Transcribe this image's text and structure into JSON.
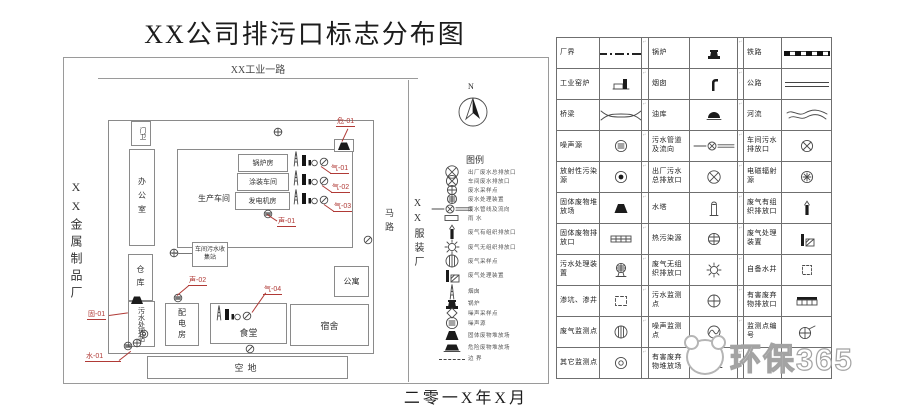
{
  "page": {
    "title": "XX公司排污口标志分布图",
    "date_label": "二零一X年X月"
  },
  "map": {
    "top_road": "XX工业一路",
    "left_neighbor": "XX金属制品厂",
    "right_neighbor": "XX服装厂",
    "road": "马路",
    "north_label": "N",
    "legend_title": "图例",
    "buildings": [
      {
        "id": "gate",
        "label": "门卫",
        "vertical": true
      },
      {
        "id": "office",
        "label": "办公室",
        "vertical": true
      },
      {
        "id": "workshop",
        "label": "生产车间",
        "vertical": false
      },
      {
        "id": "boiler-room",
        "label": "锅炉房",
        "vertical": false
      },
      {
        "id": "paint-shop",
        "label": "涂装车间",
        "vertical": false
      },
      {
        "id": "generator-room",
        "label": "发电机房",
        "vertical": false
      },
      {
        "id": "sewage-collect",
        "label": "车间污水收集站",
        "vertical": false
      },
      {
        "id": "warehouse",
        "label": "仓库",
        "vertical": true
      },
      {
        "id": "sewage-plant",
        "label": "污水处理站",
        "vertical": true
      },
      {
        "id": "power-room",
        "label": "配电房",
        "vertical": true
      },
      {
        "id": "canteen",
        "label": "食堂",
        "vertical": false
      },
      {
        "id": "dorm",
        "label": "宿舍",
        "vertical": false
      },
      {
        "id": "apartment",
        "label": "公寓",
        "vertical": false
      },
      {
        "id": "empty-lot",
        "label": "空地",
        "vertical": false
      }
    ],
    "tags": [
      {
        "id": "hazard-01",
        "label": "危-01"
      },
      {
        "id": "gas-01",
        "label": "气-01"
      },
      {
        "id": "gas-02",
        "label": "气-02"
      },
      {
        "id": "gas-03",
        "label": "气-03"
      },
      {
        "id": "gas-04",
        "label": "气-04"
      },
      {
        "id": "noise-01",
        "label": "声-01"
      },
      {
        "id": "noise-02",
        "label": "声-02"
      },
      {
        "id": "solid-01",
        "label": "固-01"
      },
      {
        "id": "water-01",
        "label": "水-01"
      }
    ],
    "mini_legend": [
      {
        "icon": "outlet-main",
        "label": "出厂废水总排放口"
      },
      {
        "icon": "outlet-workshop",
        "label": "车间废水排放口"
      },
      {
        "icon": "sample-point",
        "label": "废水采样点"
      },
      {
        "icon": "device-circle",
        "label": "废水处理装置"
      },
      {
        "icon": "pipe-flow",
        "label": "废水管线及流向"
      },
      {
        "icon": "rainwater",
        "label": "雨  水"
      },
      {
        "icon": "stack-black",
        "label": "废气有组织排放口"
      },
      {
        "icon": "sun",
        "label": "废气无组织排放口"
      },
      {
        "icon": "monitor-gas",
        "label": "废气采样点"
      },
      {
        "icon": "gas-treat",
        "label": "废气处理装置"
      },
      {
        "icon": "chimney-tower",
        "label": "烟囱"
      },
      {
        "icon": "boiler",
        "label": "锅炉"
      },
      {
        "icon": "noise-sample",
        "label": "噪声采样点"
      },
      {
        "icon": "noise-source",
        "label": "噪声源"
      },
      {
        "icon": "solid-waste",
        "label": "固体废物堆放场"
      },
      {
        "icon": "harmful-site",
        "label": "危险废物堆放场"
      },
      {
        "icon": "border-dash",
        "label": "边  界"
      }
    ]
  },
  "legend_table": {
    "rows": [
      [
        {
          "label": "厂界",
          "icon": "boundary-line"
        },
        {
          "label": "锅炉",
          "icon": "boiler"
        },
        {
          "label": "铁路",
          "icon": "railway"
        }
      ],
      [
        {
          "label": "工业窑炉",
          "icon": "kiln"
        },
        {
          "label": "烟囱",
          "icon": "chimney"
        },
        {
          "label": "公路",
          "icon": "highway"
        }
      ],
      [
        {
          "label": "桥梁",
          "icon": "bridge"
        },
        {
          "label": "油库",
          "icon": "oil-depot"
        },
        {
          "label": "河流",
          "icon": "river"
        }
      ],
      [
        {
          "label": "噪声源",
          "icon": "noise-source"
        },
        {
          "label": "污水管道及流向",
          "icon": "pipe-flow"
        },
        {
          "label": "车间污水排放口",
          "icon": "outlet-workshop"
        }
      ],
      [
        {
          "label": "放射性污染源",
          "icon": "radioactive"
        },
        {
          "label": "出厂污水总排放口",
          "icon": "outlet-main"
        },
        {
          "label": "电磁辐射源",
          "icon": "emag"
        }
      ],
      [
        {
          "label": "固体废物堆放场",
          "icon": "solid-waste"
        },
        {
          "label": "水塔",
          "icon": "water-tower"
        },
        {
          "label": "废气有组织排放口",
          "icon": "stack-black"
        }
      ],
      [
        {
          "label": "固体废物排放口",
          "icon": "solid-outlet"
        },
        {
          "label": "热污染源",
          "icon": "thermal"
        },
        {
          "label": "废气处理装置",
          "icon": "gas-treat"
        }
      ],
      [
        {
          "label": "污水处理装置",
          "icon": "sewage-treat"
        },
        {
          "label": "废气无组织排放口",
          "icon": "sun"
        },
        {
          "label": "自备水井",
          "icon": "well"
        }
      ],
      [
        {
          "label": "渗坑、渗井",
          "icon": "seepage"
        },
        {
          "label": "污水监测点",
          "icon": "monitor-water"
        },
        {
          "label": "有害废弃物排放口",
          "icon": "harmful-outlet"
        }
      ],
      [
        {
          "label": "废气监测点",
          "icon": "monitor-gas"
        },
        {
          "label": "噪声监测点",
          "icon": "monitor-noise"
        },
        {
          "label": "监测点编号",
          "icon": "monitor-num"
        }
      ],
      [
        {
          "label": "其它监测点",
          "icon": "monitor-other"
        },
        {
          "label": "有害废弃物堆放场",
          "icon": "harmful-site"
        },
        {
          "label": "",
          "icon": ""
        }
      ]
    ]
  },
  "watermark": {
    "text": "环保365"
  },
  "colors": {
    "tag_red": "#b03a36",
    "line": "#4a4a4a"
  }
}
